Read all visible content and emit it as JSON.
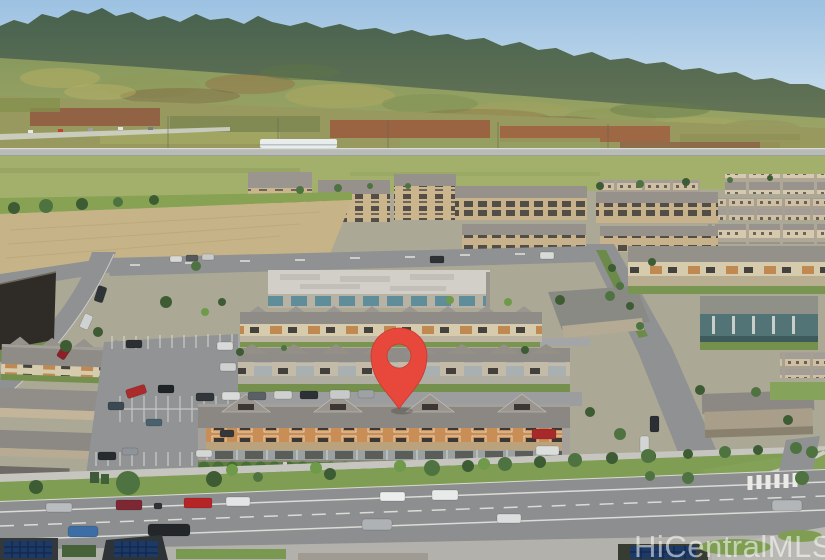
{
  "image": {
    "kind": "aerial-photograph",
    "description": "Aerial drone photo of a master-planned townhome community in front of a mountain ridge, with farmland, an elevated rail guideway, a wide boulevard in the foreground, and a red location pin marking a row of orange townhouses",
    "watermark": "HiCentralMLS"
  },
  "marker": {
    "name": "property-location-pin",
    "color": "#e8473b",
    "shadow": "rgba(0,0,0,0.18)"
  },
  "palette": {
    "sky_top": "#9cc1e2",
    "sky_horizon": "#e8f0f4",
    "mountain_ridge": "#47604d",
    "mountain_slope": "#8b9a5d",
    "farmland_red": "#99593e",
    "field_green": "#a2b06c",
    "pavement": "#8f9192",
    "roof_gray": "#8d8984",
    "tan_wall": "#d3c8ae",
    "subject_wall_orange": "#c98e55",
    "teal_glass": "#5f8d99",
    "landscape_green": "#4f7a3c",
    "watermark": "rgba(255,255,255,0.55)"
  }
}
